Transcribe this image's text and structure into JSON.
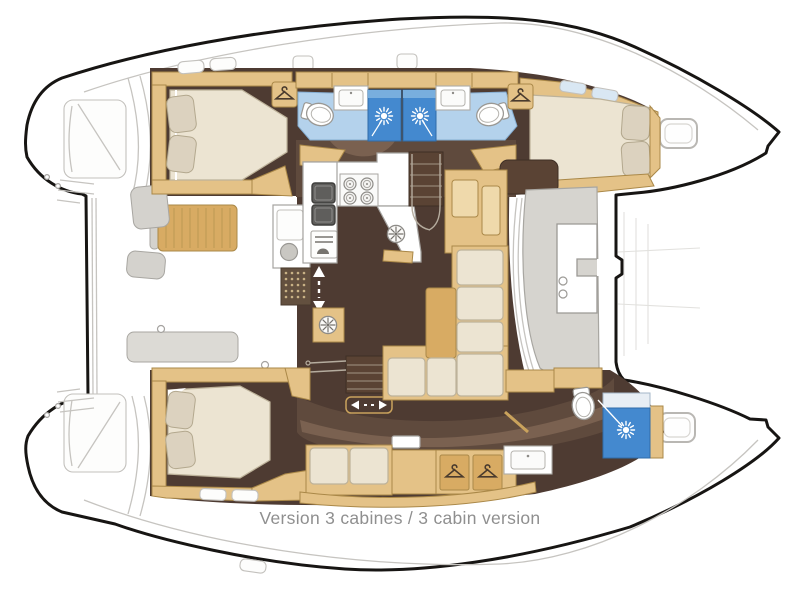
{
  "caption": "Version 3 cabines / 3 cabin version",
  "diagram_type": "catamaran-3-cabin-floor-plan",
  "palette": {
    "hull_outline": "#171513",
    "deck_line": "#c6c4c0",
    "deck_line_faint": "#e2e1de",
    "floor_dark": "#4e3b32",
    "floor_mid": "#5f4a3d",
    "floor_light": "#7a6150",
    "wood": "#e4c287",
    "wood_mid": "#d8ab63",
    "wood_dark": "#aa8848",
    "wood_light": "#efd9ab",
    "cream": "#ece4d2",
    "cream_edge": "#bdb29a",
    "pillow": "#dcd2bf",
    "seat_gray": "#d4d2cd",
    "seat_gray_edge": "#a8a6a1",
    "bath_floor_blue": "#b4d2ec",
    "shower_blue": "#4489cf",
    "shower_blue_light": "#78aede",
    "darkwood": "#5a4334",
    "caption_gray": "#8f8f8f"
  },
  "icons": {
    "shower_head": "white sunburst on blue shower stall",
    "hanging_locker": "clothes hanger in wood square",
    "vent_hatch": "gray circle with spokes",
    "companionway": "vertical dashed double arrow",
    "sliding_door": "horizontal arrows with dashes",
    "stove": "four burner rings"
  },
  "features": {
    "cabins": 3,
    "double_beds": 3,
    "bathrooms": 3,
    "showers": 3,
    "toilets": 3,
    "hanging_lockers": 4,
    "galley_burners": 4
  }
}
